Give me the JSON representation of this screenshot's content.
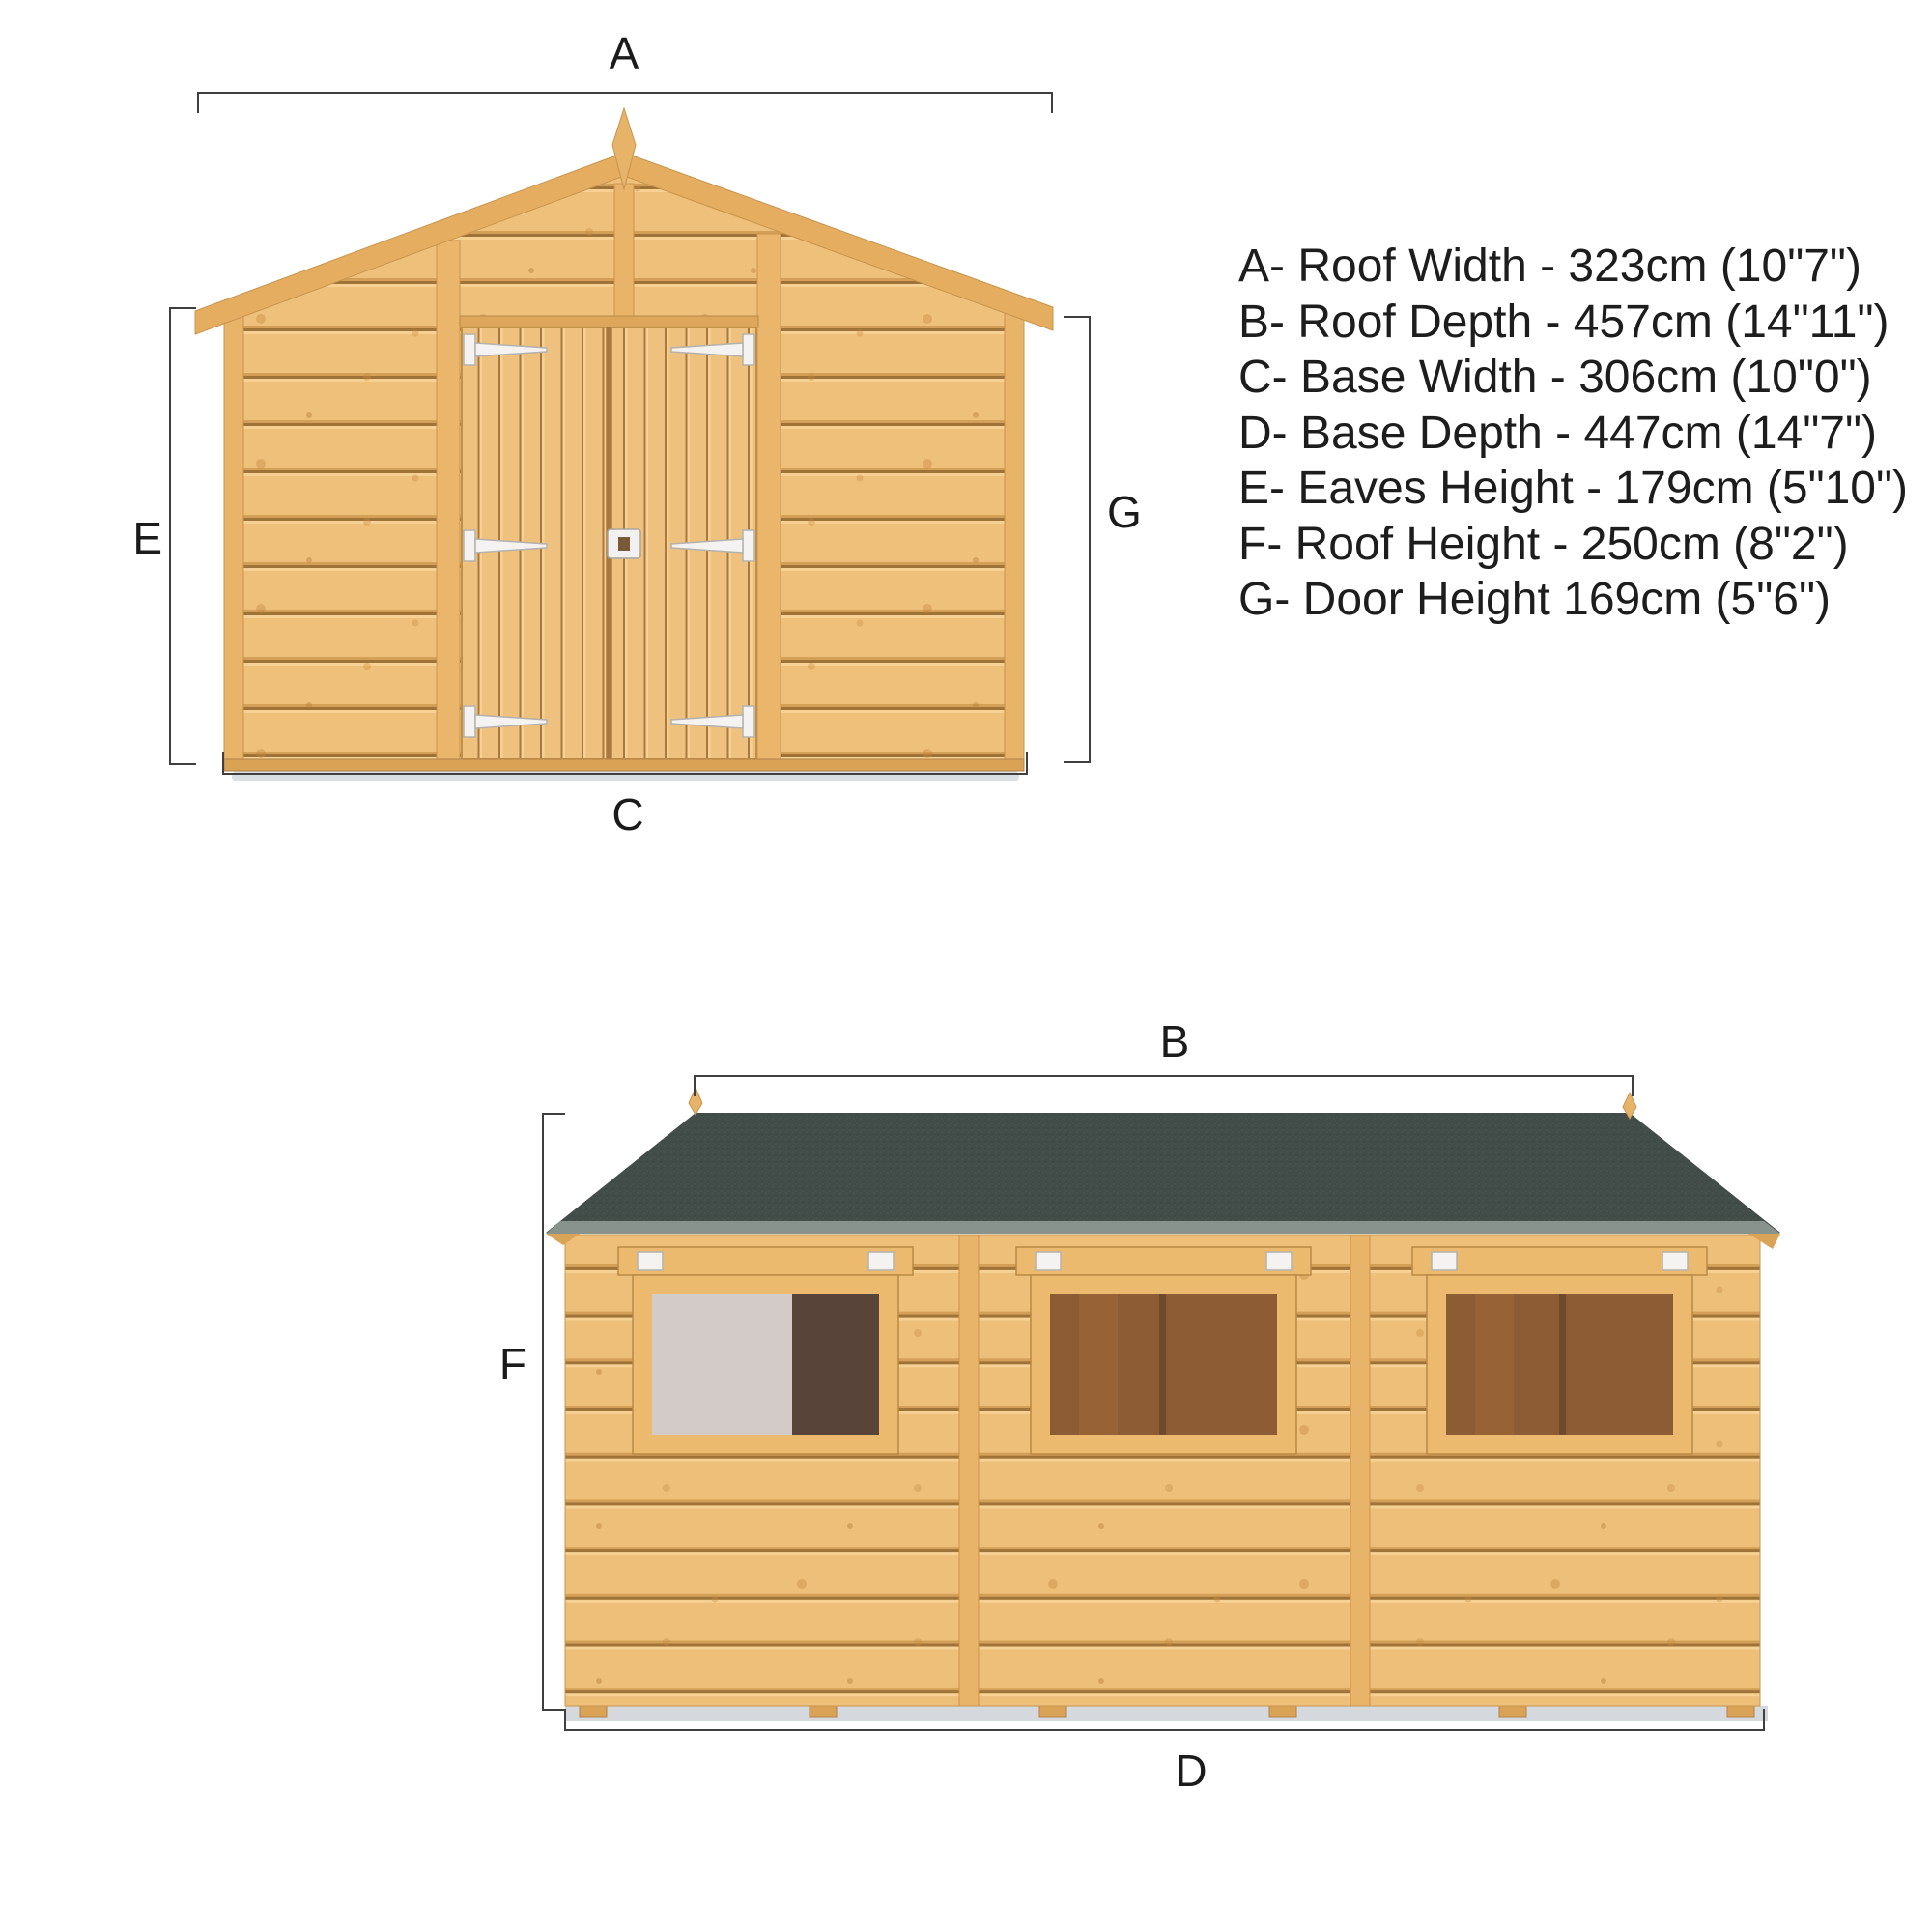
{
  "front_view": {
    "label_a": "A",
    "label_c": "C",
    "label_e": "E",
    "label_g": "G"
  },
  "side_view": {
    "label_b": "B",
    "label_d": "D",
    "label_f": "F"
  },
  "specs": [
    {
      "key": "A",
      "name": "Roof Width",
      "metric_cm": 323,
      "imperial": "10\"7\"",
      "display": "A- Roof Width - 323cm (10\"7\")"
    },
    {
      "key": "B",
      "name": "Roof Depth",
      "metric_cm": 457,
      "imperial": "14\"11\"",
      "display": "B- Roof Depth - 457cm (14\"11\")"
    },
    {
      "key": "C",
      "name": "Base Width",
      "metric_cm": 306,
      "imperial": "10\"0\"",
      "display": "C- Base Width - 306cm (10\"0\")"
    },
    {
      "key": "D",
      "name": "Base Depth",
      "metric_cm": 447,
      "imperial": "14\"7\"",
      "display": "D- Base Depth - 447cm (14\"7\")"
    },
    {
      "key": "E",
      "name": "Eaves Height",
      "metric_cm": 179,
      "imperial": "5\"10\"",
      "display": "E- Eaves Height - 179cm (5\"10\")"
    },
    {
      "key": "F",
      "name": "Roof Height",
      "metric_cm": 250,
      "imperial": "8\"2\"",
      "display": "F- Roof Height - 250cm (8\"2\")"
    },
    {
      "key": "G",
      "name": "Door Height",
      "metric_cm": 169,
      "imperial": "5\"6\"",
      "display": "G- Door Height 169cm (5\"6\")"
    }
  ],
  "colors": {
    "wood_base": "#eec07a",
    "wood_highlight": "#f6d193",
    "wood_groove": "#a87840",
    "wood_trim": "#e4ad60",
    "roof_felt": "#424d49",
    "roof_edge": "#89938d",
    "hinge_white": "#f4f3f1",
    "glazing_amber": "#8d5c35",
    "glazing_grey": "#d3cbc7",
    "glazing_dark": "#584438",
    "dimension_line": "#3f3f3f",
    "text": "#1d1d1d"
  }
}
